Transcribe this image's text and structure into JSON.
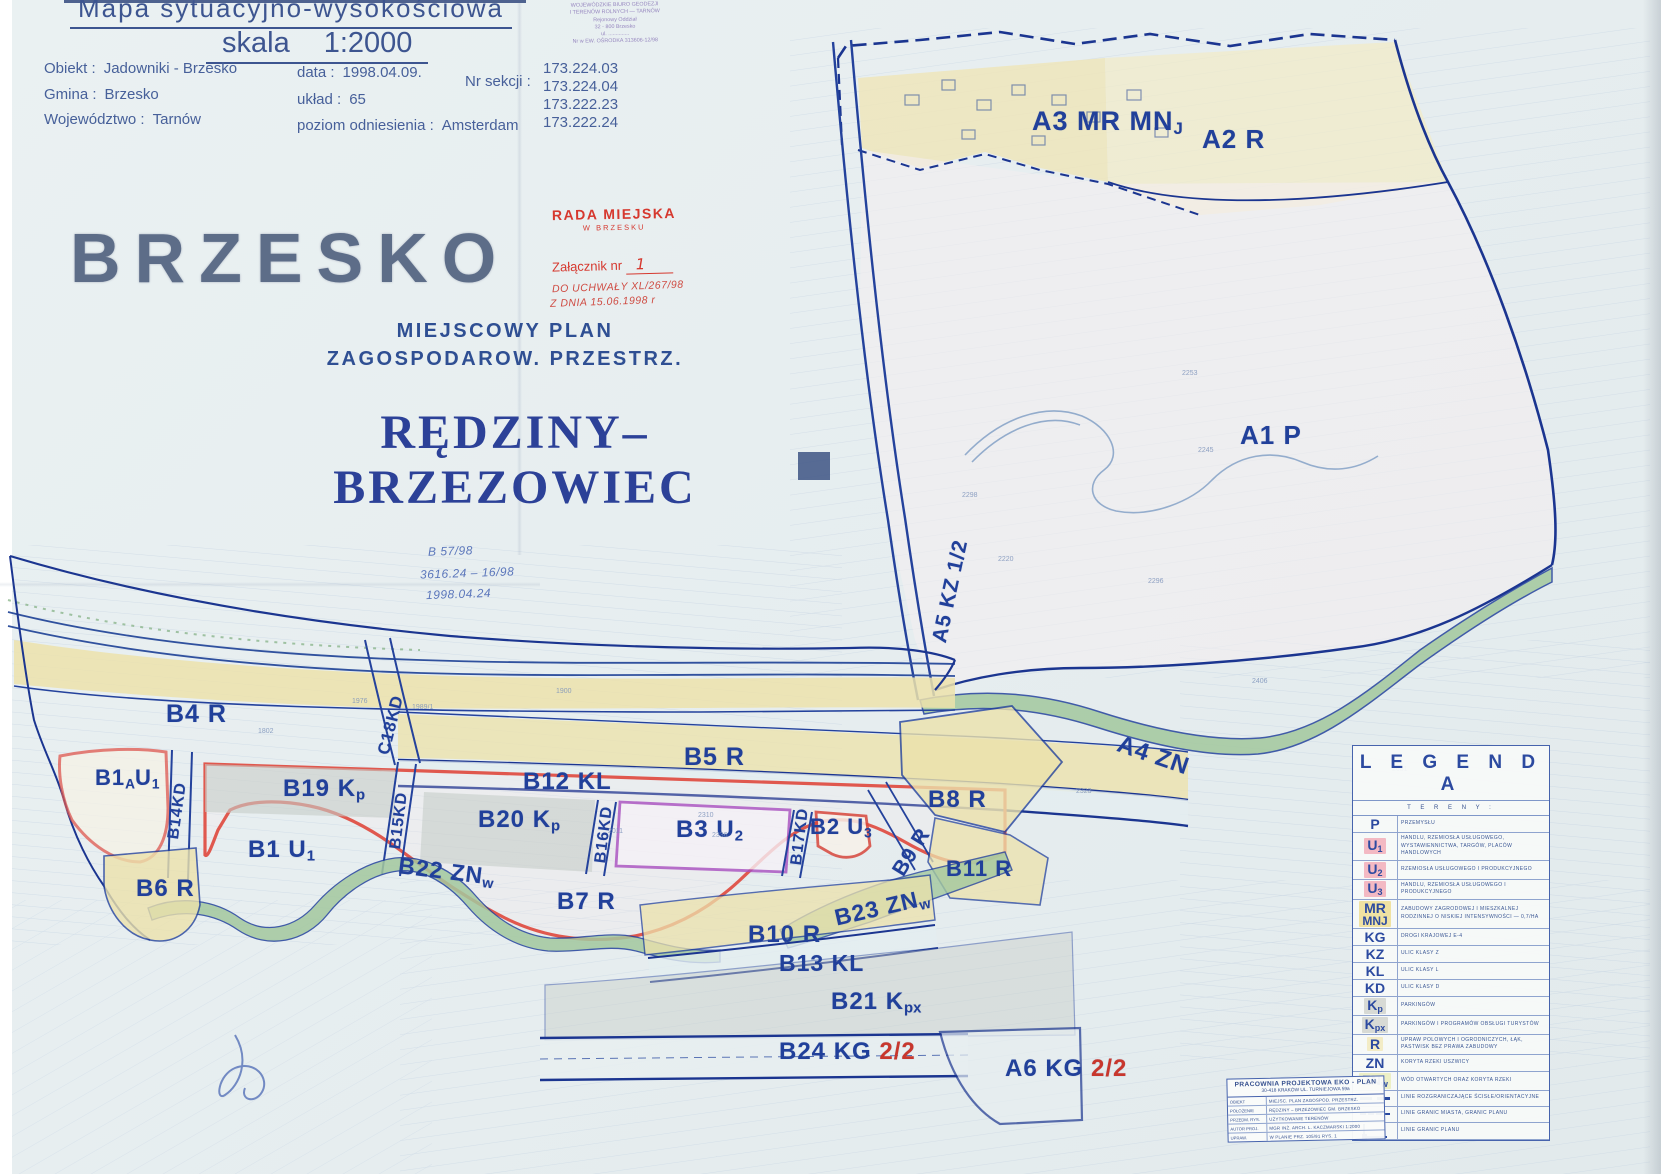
{
  "title_block": {
    "map_title": "Mapa  sytuacyjno-wysokościowa",
    "scale_label": "skala",
    "scale_value": "1:2000",
    "fields": [
      {
        "label": "Obiekt :",
        "value": "Jadowniki - Brzesko"
      },
      {
        "label": "Gmina :",
        "value": "Brzesko"
      },
      {
        "label": "Województwo :",
        "value": "Tarnów"
      },
      {
        "label": "data :",
        "value": "1998.04.09."
      },
      {
        "label": "układ :",
        "value": "65"
      },
      {
        "label": "poziom odniesienia :",
        "value": "Amsterdam"
      }
    ],
    "nr_sekcji_label": "Nr sekcji :",
    "nr_sekcji": [
      "173.224.03",
      "173.224.04",
      "173.222.23",
      "173.222.24"
    ]
  },
  "headings": {
    "city": "BRZESKO",
    "plan_line1": "MIEJSCOWY  PLAN",
    "plan_line2": "ZAGOSPODAROW. PRZESTRZ.",
    "area_line1": "RĘDZINY–",
    "area_line2": "BRZEZOWIEC"
  },
  "stamps": {
    "geodesy_lines": [
      "WOJEWÓDZKIE BIURO GEODEZJI",
      "I TERENÓW ROLNYCH — TARNÓW",
      "Rejonowy Oddział",
      "32 - 800  Brzesko",
      "ul. ..............",
      "Nr w EW. OŚRODKA 313606-12/98"
    ],
    "council_line1": "RADA MIEJSKA",
    "council_line2": "W BRZESKU",
    "attachment_label": "Załącznik nr",
    "attachment_no": "1",
    "attachment_note1": "DO UCHWAŁY XL/267/98",
    "attachment_note2": "Z DNIA 15.06.1998 r",
    "survey_note1": "B 57/98",
    "survey_note2": "3616.24 – 16/98",
    "survey_note3": "1998.04.24"
  },
  "map": {
    "zones": {
      "a3": {
        "parts": [
          [
            "n",
            "A3 MR MN"
          ],
          [
            "s",
            "J"
          ]
        ]
      },
      "a2": {
        "parts": [
          [
            "n",
            "A2 R"
          ]
        ]
      },
      "a1": {
        "parts": [
          [
            "n",
            "A1 P"
          ]
        ]
      },
      "a5": {
        "parts": [
          [
            "n",
            "A5 KZ 1/2"
          ]
        ]
      },
      "a4": {
        "parts": [
          [
            "n",
            "A4 ZN"
          ]
        ]
      },
      "a6": {
        "parts": [
          [
            "n",
            "A6 KG "
          ],
          [
            "r",
            "2/2"
          ]
        ]
      },
      "b4": {
        "parts": [
          [
            "n",
            "B4 R"
          ]
        ]
      },
      "b5": {
        "parts": [
          [
            "n",
            "B5 R"
          ]
        ]
      },
      "b1a": {
        "parts": [
          [
            "n",
            "B1"
          ],
          [
            "s",
            "A"
          ],
          [
            "n",
            "U"
          ],
          [
            "s",
            "1"
          ]
        ]
      },
      "b1": {
        "parts": [
          [
            "n",
            "B1 U"
          ],
          [
            "s",
            "1"
          ]
        ]
      },
      "b2": {
        "parts": [
          [
            "n",
            "B2 U"
          ],
          [
            "s",
            "3"
          ]
        ]
      },
      "b3": {
        "parts": [
          [
            "n",
            "B3 U"
          ],
          [
            "s",
            "2"
          ]
        ]
      },
      "b6": {
        "parts": [
          [
            "n",
            "B6 R"
          ]
        ]
      },
      "b7": {
        "parts": [
          [
            "n",
            "B7 R"
          ]
        ]
      },
      "b8": {
        "parts": [
          [
            "n",
            "B8 R"
          ]
        ]
      },
      "b9": {
        "parts": [
          [
            "n",
            "B9 R"
          ]
        ]
      },
      "b10": {
        "parts": [
          [
            "n",
            "B10 R"
          ]
        ]
      },
      "b11": {
        "parts": [
          [
            "n",
            "B11 R"
          ]
        ]
      },
      "b12": {
        "parts": [
          [
            "n",
            "B12 KL"
          ]
        ]
      },
      "b13": {
        "parts": [
          [
            "n",
            "B13 KL"
          ]
        ]
      },
      "b19": {
        "parts": [
          [
            "n",
            "B19 K"
          ],
          [
            "s",
            "p"
          ]
        ]
      },
      "b20": {
        "parts": [
          [
            "n",
            "B20 K"
          ],
          [
            "s",
            "p"
          ]
        ]
      },
      "b21": {
        "parts": [
          [
            "n",
            "B21 K"
          ],
          [
            "s",
            "px"
          ]
        ]
      },
      "b22": {
        "parts": [
          [
            "n",
            "B22 ZN"
          ],
          [
            "s",
            "w"
          ]
        ]
      },
      "b23": {
        "parts": [
          [
            "n",
            "B23 ZN"
          ],
          [
            "s",
            "w"
          ]
        ]
      },
      "b24": {
        "parts": [
          [
            "n",
            "B24 KG "
          ],
          [
            "r",
            "2/2"
          ]
        ]
      },
      "c18kd": {
        "parts": [
          [
            "n",
            "C18KD"
          ]
        ]
      },
      "b14kd": {
        "parts": [
          [
            "n",
            "B14KD"
          ]
        ]
      },
      "b15kd": {
        "parts": [
          [
            "n",
            "B15KD"
          ]
        ]
      },
      "b16kd": {
        "parts": [
          [
            "n",
            "B16KD"
          ]
        ]
      },
      "b17kd": {
        "parts": [
          [
            "n",
            "B17KD"
          ]
        ]
      }
    },
    "parcel_numbers": [
      "2245",
      "2253",
      "2298",
      "2296",
      "2220",
      "2336",
      "2310",
      "1989/1",
      "1976",
      "1802",
      "2631",
      "2406",
      "2323",
      "1900",
      "2011"
    ]
  },
  "legend": {
    "title": "L E G E N D A",
    "subtitle": "T E R E N Y :",
    "rows": [
      {
        "code": "P",
        "sub": "",
        "bg": "",
        "desc": "PRZEMYSŁU"
      },
      {
        "code": "U",
        "sub": "1",
        "bg": "#f3b9c3",
        "desc": "HANDLU, RZEMIOSŁA USŁUGOWEGO, WYSTAWIENNICTWA, TARGÓW, PLACÓW HANDLOWYCH"
      },
      {
        "code": "U",
        "sub": "2",
        "bg": "#f3b9c3",
        "desc": "RZEMIOSŁA USŁUGOWEGO I PRODUKCYJNEGO"
      },
      {
        "code": "U",
        "sub": "3",
        "bg": "#f3b9c3",
        "desc": "HANDLU, RZEMIOSŁA USŁUGOWEGO I PRODUKCYJNEGO"
      },
      {
        "code": "MR",
        "sub": "",
        "code2": "MNJ",
        "bg": "#f0e2a2",
        "desc": "ZABUDOWY ZAGRODOWEJ I MIESZKALNEJ RODZINNEJ O NISKIEJ INTENSYWNOŚCI — 0,7/HA"
      },
      {
        "code": "KG",
        "sub": "",
        "bg": "",
        "desc": "DROGI KRAJOWEJ E-4"
      },
      {
        "code": "KZ",
        "sub": "",
        "bg": "",
        "desc": "ULIC KLASY Z"
      },
      {
        "code": "KL",
        "sub": "",
        "bg": "",
        "desc": "ULIC KLASY L"
      },
      {
        "code": "KD",
        "sub": "",
        "bg": "",
        "desc": "ULIC KLASY D"
      },
      {
        "code": "K",
        "sub": "p",
        "bg": "#d7dad5",
        "desc": "PARKINGÓW"
      },
      {
        "code": "K",
        "sub": "px",
        "bg": "#d7dad5",
        "desc": "PARKINGÓW I PROGRAMÓW OBSŁUGI TURYSTÓW"
      },
      {
        "code": "R",
        "sub": "",
        "bg": "#f3ecc6",
        "desc": "UPRAW POLOWYCH I OGRODNICZYCH, ŁĄK, PASTWISK BEZ PRAWA ZABUDOWY"
      },
      {
        "code": "ZN",
        "sub": "",
        "bg": "",
        "desc": "KORYTA RZEKI USZWICY"
      },
      {
        "code": "ZN",
        "sub": "w",
        "bg": "#edf0c6",
        "desc": "WÓD OTWARTYCH ORAZ KORYTA RZEKI"
      },
      {
        "symbol": "bound",
        "desc": "LINIE ROZGRANICZAJĄCE ŚCISŁE/ORIENTACYJNE"
      },
      {
        "symbol": "city",
        "desc": "LINIE GRANIC MIASTA, GRANIC PLANU"
      },
      {
        "symbol": "corner",
        "desc": "LINIE GRANIC PLANU"
      }
    ]
  },
  "publisher": {
    "name": "PRACOWNIA PROJEKTOWA  EKO - PLAN",
    "address": "30-418  KRAKÓW   UL. TURNIEJOWA  59a",
    "rows": [
      [
        "OBIEKT",
        "MIEJSC. PLAN ZAGOSPOD. PRZESTRZ."
      ],
      [
        "POŁOŻENIE",
        "RĘDZINY – BRZEZOWIEC  GM. BRZESKO"
      ],
      [
        "PRZEDM. RYS.",
        "UŻYTKOWANIE TERENÓW"
      ],
      [
        "AUTOR PROJ.",
        "MGR INŻ. ARCH. L. KACZMARSKI    1:2000"
      ],
      [
        "UPRAW.",
        "W PLANIE PRZ. 105/91    RYS. 1"
      ]
    ]
  },
  "colors": {
    "navy": "#24429c",
    "boundary": "#1b3590",
    "red_outline": "#e0584e",
    "magenta": "#a94fc0",
    "zone_yellow": "#ece2ac",
    "zone_gray": "#c7cdc8",
    "zone_green": "#a3c89e",
    "stamp_red": "#d6382e",
    "stamp_purple": "#9282bd"
  }
}
